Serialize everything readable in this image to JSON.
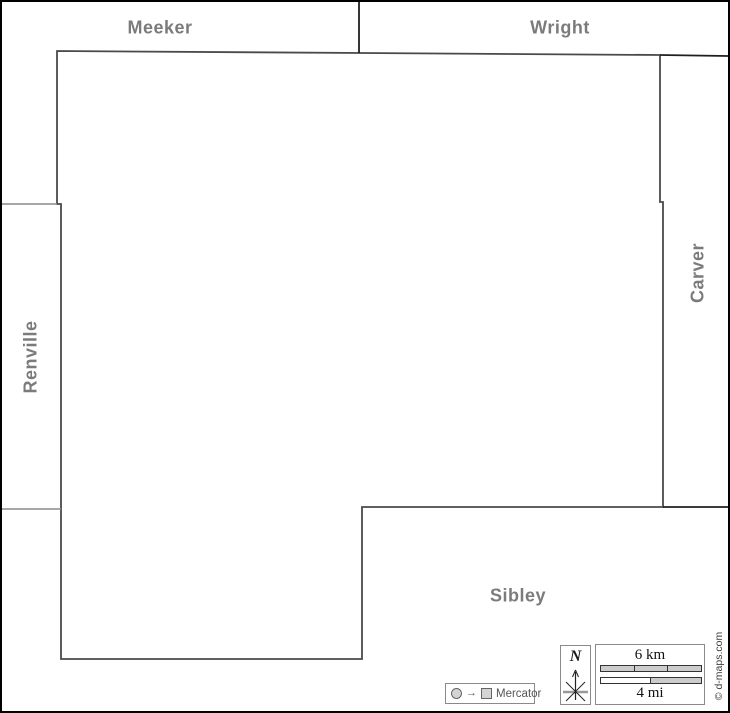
{
  "neighbors": {
    "meeker": "Meeker",
    "wright": "Wright",
    "carver": "Carver",
    "renville": "Renville",
    "sibley": "Sibley"
  },
  "compass": {
    "north": "N"
  },
  "scalebar": {
    "km": "6 km",
    "mi": "4 mi"
  },
  "projection": {
    "name": "Mercator"
  },
  "credit": {
    "text": "© d-maps.com"
  },
  "colors": {
    "label_gray": "#7b7b7b",
    "county_outline": "#4a4a4a",
    "neighbor_line_light": "#8a8a8a",
    "neighbor_line_dark": "#1f1f1f",
    "frame": "#000000",
    "scale_fill": "#cccccc",
    "box_border": "#8a8a8a",
    "credit_color": "#3c3c3c"
  }
}
